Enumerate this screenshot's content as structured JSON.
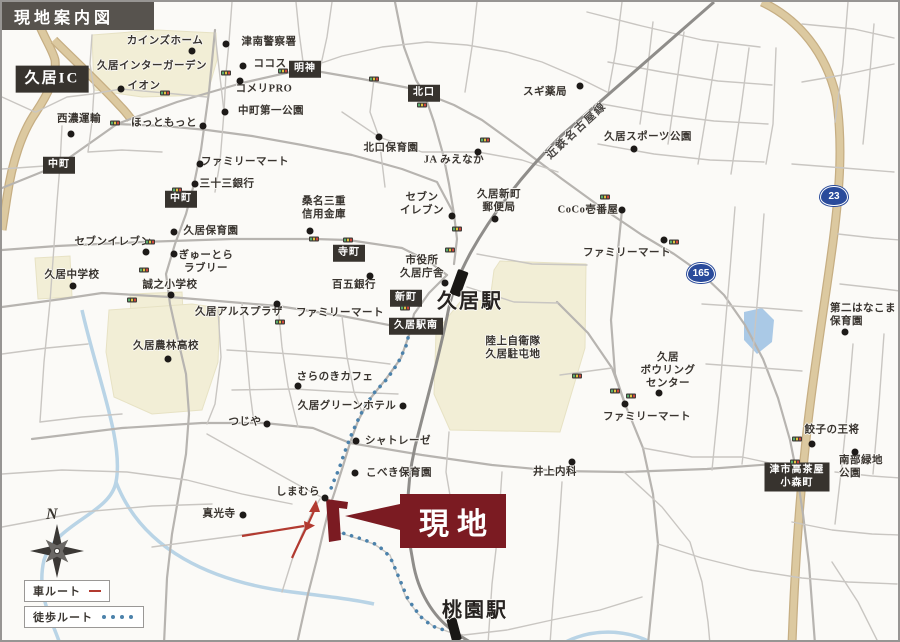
{
  "header": {
    "title": "現地案内図"
  },
  "site": {
    "banner_label": "現地"
  },
  "legend": {
    "car_label": "車ルート",
    "walk_label": "徒歩ルート"
  },
  "compass": {
    "north_label": "N"
  },
  "railway": {
    "name": "近鉄名古屋線"
  },
  "colors": {
    "site_red": "#7b1b22",
    "car_route_red": "#b23a30",
    "walk_route_blue": "#4c82ab",
    "route_badge_blue": "#2a4b9b",
    "school_area_cream": "#f2eed6",
    "highway_tan": "#dcc9a0",
    "label_box_dark": "#37332e",
    "header_gray": "#57534e",
    "water_blue": "#aac9e6"
  },
  "map": {
    "stations": [
      {
        "name": "久居駅",
        "x": 468,
        "y": 297
      },
      {
        "name": "桃園駅",
        "x": 473,
        "y": 606
      }
    ],
    "route_badges": [
      {
        "number": "23",
        "x": 832,
        "y": 194
      },
      {
        "number": "165",
        "x": 699,
        "y": 271
      }
    ],
    "box_labels": [
      {
        "text": "久居IC",
        "x": 50,
        "y": 77,
        "large": true
      },
      {
        "text": "中町",
        "x": 57,
        "y": 163
      },
      {
        "text": "中町",
        "x": 179,
        "y": 197
      },
      {
        "text": "明神",
        "x": 303,
        "y": 67
      },
      {
        "text": "北口",
        "x": 422,
        "y": 91
      },
      {
        "text": "寺町",
        "x": 347,
        "y": 251
      },
      {
        "text": "新町",
        "x": 404,
        "y": 296
      },
      {
        "text": "久居駅南",
        "x": 414,
        "y": 324
      },
      {
        "text": "津市高茶屋\n小森町",
        "x": 795,
        "y": 475
      }
    ],
    "pois": [
      {
        "text": "カインズホーム",
        "x": 163,
        "y": 40,
        "dot": [
          190,
          49
        ]
      },
      {
        "text": "津南警察署",
        "x": 267,
        "y": 41,
        "dot": [
          224,
          42
        ]
      },
      {
        "text": "ココス",
        "x": 268,
        "y": 63,
        "dot": [
          241,
          64
        ]
      },
      {
        "text": "久居インターガーデン",
        "x": 150,
        "y": 65
      },
      {
        "text": "イオン",
        "x": 142,
        "y": 85,
        "dot": [
          119,
          87
        ]
      },
      {
        "text": "コメリPRO",
        "x": 262,
        "y": 88,
        "dot": [
          238,
          79
        ]
      },
      {
        "text": "西濃運輸",
        "x": 77,
        "y": 118,
        "dot": [
          69,
          132
        ]
      },
      {
        "text": "ほっともっと",
        "x": 162,
        "y": 122,
        "dot": [
          201,
          124
        ]
      },
      {
        "text": "中町第一公園",
        "x": 269,
        "y": 110,
        "dot": [
          223,
          110
        ]
      },
      {
        "text": "北口保育園",
        "x": 389,
        "y": 147,
        "dot": [
          377,
          135
        ]
      },
      {
        "text": "JA みえなか",
        "x": 452,
        "y": 159,
        "dot": [
          476,
          150
        ]
      },
      {
        "text": "スギ薬局",
        "x": 543,
        "y": 91,
        "dot": [
          578,
          84
        ]
      },
      {
        "text": "久居スポーツ公園",
        "x": 646,
        "y": 136,
        "dot": [
          632,
          147
        ]
      },
      {
        "text": "ファミリーマート",
        "x": 243,
        "y": 161,
        "dot": [
          198,
          162
        ]
      },
      {
        "text": "三十三銀行",
        "x": 225,
        "y": 183,
        "dot": [
          193,
          182
        ]
      },
      {
        "text": "久居保育園",
        "x": 209,
        "y": 230,
        "dot": [
          172,
          230
        ]
      },
      {
        "text": "セブンイレブン",
        "x": 111,
        "y": 241,
        "dot": [
          144,
          250
        ]
      },
      {
        "text": "ぎゅーとら\nラブリー",
        "x": 204,
        "y": 261,
        "dot": [
          172,
          252
        ]
      },
      {
        "text": "久居中学校",
        "x": 70,
        "y": 274,
        "dot": [
          71,
          284
        ]
      },
      {
        "text": "誠之小学校",
        "x": 168,
        "y": 284,
        "dot": [
          169,
          293
        ]
      },
      {
        "text": "桑名三重\n信用金庫",
        "x": 322,
        "y": 207,
        "dot": [
          308,
          229
        ]
      },
      {
        "text": "セブン\nイレブン",
        "x": 420,
        "y": 203,
        "dot": [
          450,
          214
        ]
      },
      {
        "text": "久居新町\n郵便局",
        "x": 497,
        "y": 200,
        "dot": [
          493,
          217
        ]
      },
      {
        "text": "CoCo壱番屋",
        "x": 586,
        "y": 209,
        "dot": [
          620,
          208
        ]
      },
      {
        "text": "ファミリーマート",
        "x": 625,
        "y": 252,
        "dot": [
          662,
          238
        ]
      },
      {
        "text": "市役所\n久居庁舎",
        "x": 420,
        "y": 266,
        "dot": [
          443,
          281
        ]
      },
      {
        "text": "百五銀行",
        "x": 352,
        "y": 284,
        "dot": [
          368,
          274
        ]
      },
      {
        "text": "久居アルスプラザ",
        "x": 237,
        "y": 311,
        "dot": [
          275,
          302
        ]
      },
      {
        "text": "ファミリーマート",
        "x": 338,
        "y": 312
      },
      {
        "text": "久居農林高校",
        "x": 164,
        "y": 345,
        "dot": [
          166,
          357
        ]
      },
      {
        "text": "陸上自衛隊\n久居駐屯地",
        "x": 511,
        "y": 347
      },
      {
        "text": "久居\nボウリング\nセンター",
        "x": 666,
        "y": 369,
        "dot": [
          657,
          391
        ]
      },
      {
        "text": "ファミリーマート",
        "x": 645,
        "y": 416,
        "dot": [
          623,
          402
        ]
      },
      {
        "text": "第二はなこま\n保育園",
        "x": 828,
        "y": 314,
        "align": "left",
        "dot": [
          843,
          330
        ]
      },
      {
        "text": "餃子の王将",
        "x": 830,
        "y": 429,
        "dot": [
          810,
          442
        ]
      },
      {
        "text": "南部緑地\n公園",
        "x": 837,
        "y": 466,
        "align": "left",
        "dot": [
          853,
          450
        ]
      },
      {
        "text": "さらのきカフェ",
        "x": 333,
        "y": 376,
        "dot": [
          296,
          384
        ]
      },
      {
        "text": "久居グリーンホテル",
        "x": 345,
        "y": 405,
        "dot": [
          401,
          404
        ]
      },
      {
        "text": "つじや",
        "x": 243,
        "y": 421,
        "dot": [
          265,
          422
        ]
      },
      {
        "text": "シャトレーゼ",
        "x": 396,
        "y": 440,
        "dot": [
          354,
          439
        ]
      },
      {
        "text": "こべき保育園",
        "x": 397,
        "y": 472,
        "dot": [
          353,
          471
        ]
      },
      {
        "text": "井上内科",
        "x": 553,
        "y": 471,
        "dot": [
          570,
          460
        ]
      },
      {
        "text": "しまむら",
        "x": 296,
        "y": 491,
        "dot": [
          323,
          496
        ]
      },
      {
        "text": "真光寺",
        "x": 217,
        "y": 513,
        "dot": [
          241,
          513
        ]
      }
    ],
    "signals": [
      [
        224,
        71
      ],
      [
        163,
        91
      ],
      [
        113,
        121
      ],
      [
        281,
        69
      ],
      [
        372,
        77
      ],
      [
        420,
        103
      ],
      [
        483,
        138
      ],
      [
        603,
        195
      ],
      [
        672,
        240
      ],
      [
        175,
        188
      ],
      [
        148,
        240
      ],
      [
        312,
        237
      ],
      [
        346,
        238
      ],
      [
        142,
        268
      ],
      [
        130,
        298
      ],
      [
        403,
        306
      ],
      [
        455,
        227
      ],
      [
        448,
        248
      ],
      [
        278,
        320
      ],
      [
        575,
        374
      ],
      [
        613,
        389
      ],
      [
        629,
        394
      ],
      [
        795,
        437
      ],
      [
        793,
        460
      ]
    ]
  }
}
